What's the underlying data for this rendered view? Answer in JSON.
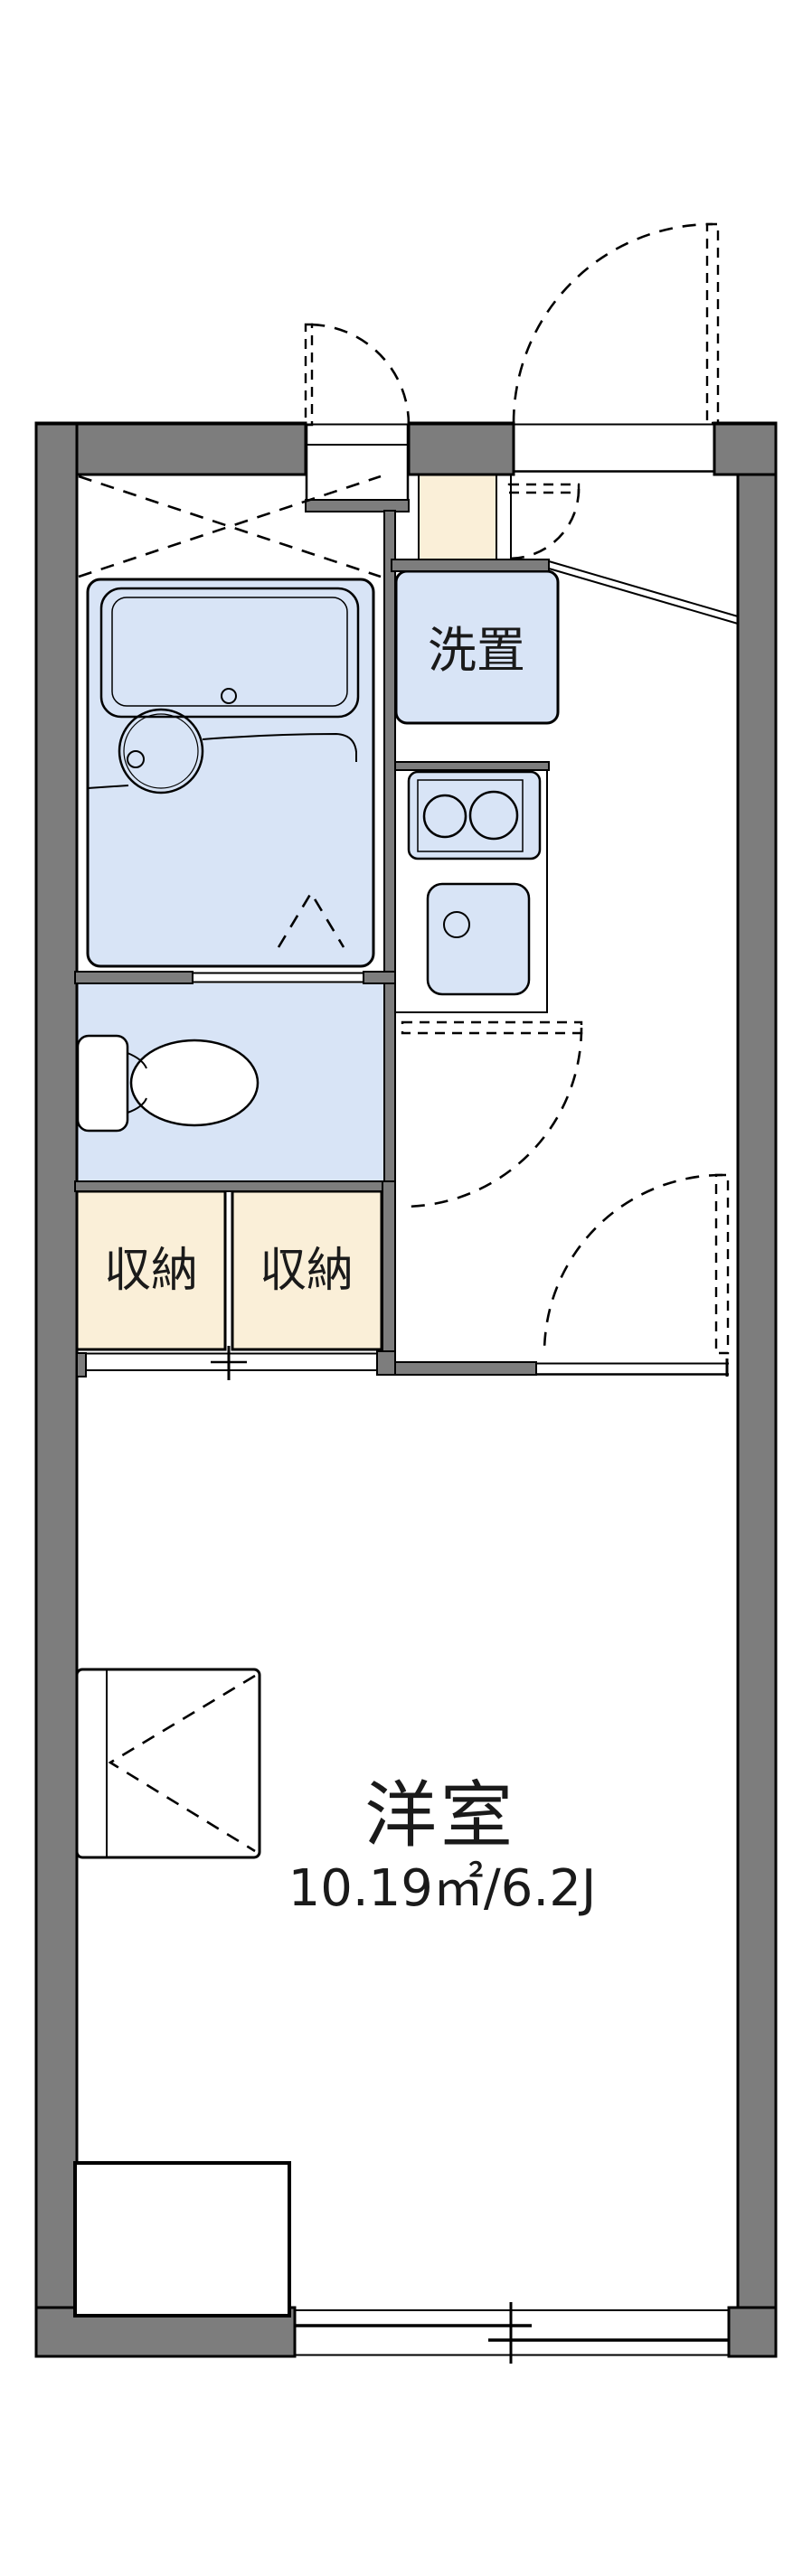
{
  "plan": {
    "labels": {
      "laundry": "洗置",
      "storage_left": "収納",
      "storage_right": "収納",
      "main_room_name": "洋室",
      "main_room_size": "10.19㎡/6.2J"
    },
    "colors": {
      "wall": "#7d7d7d",
      "water_fixture": "#d8e4f6",
      "entrance_floor": "#faefd8",
      "line": "#000000"
    }
  }
}
